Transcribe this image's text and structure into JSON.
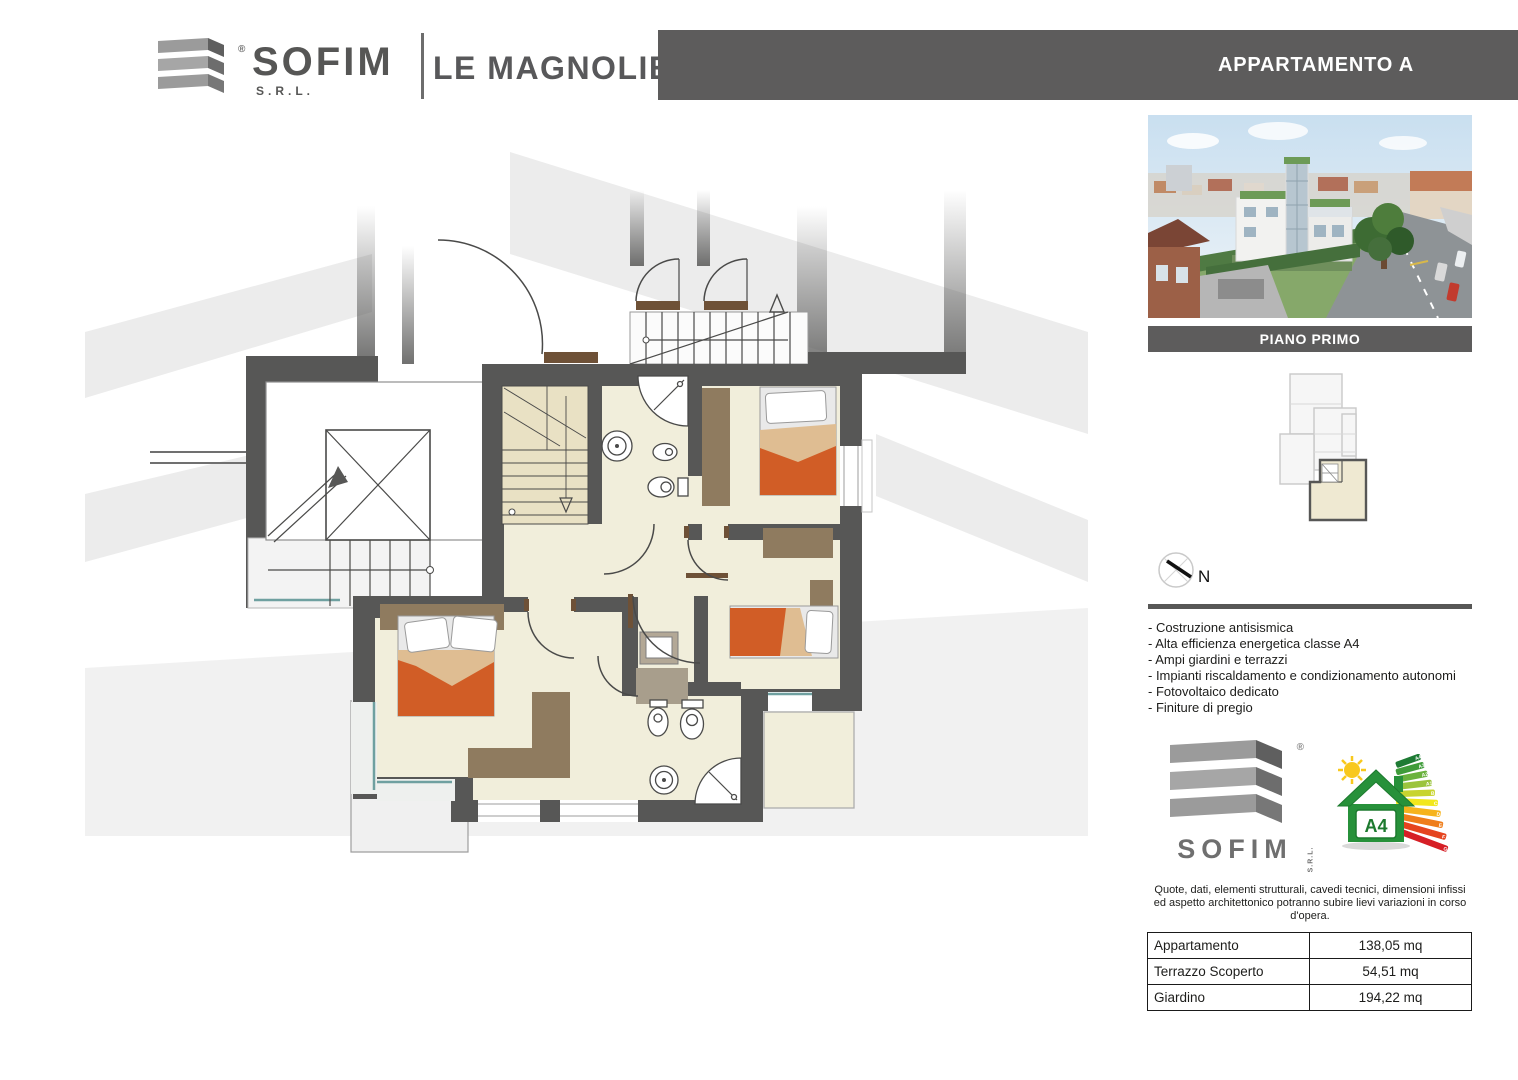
{
  "header": {
    "brand": {
      "name": "SOFIM",
      "suffix": "S.R.L.",
      "registered": "®"
    },
    "project": "LE MAGNOLIE",
    "apartment_label": "APPARTAMENTO A"
  },
  "panel": {
    "floor_label": "PIANO PRIMO",
    "compass_label": "N",
    "features": [
      "- Costruzione antisismica",
      "- Alta efficienza energetica classe A4",
      "- Ampi giardini e terrazzi",
      "- Impianti riscaldamento e condizionamento autonomi",
      "- Fotovoltaico dedicato",
      "- Finiture di pregio"
    ],
    "footer_logo": {
      "name": "SOFIM",
      "suffix": "S.R.L.",
      "registered": "®"
    },
    "energy": {
      "class_label": "A4",
      "scale": [
        "A4",
        "A3",
        "A2",
        "A1",
        "B",
        "C",
        "D",
        "E",
        "F",
        "G"
      ]
    },
    "disclaimer": {
      "line1": "Quote, dati, elementi strutturali, cavedi tecnici, dimensioni infissi",
      "line2": "ed aspetto architettonico potranno subire lievi variazioni in corso d'opera."
    },
    "table": {
      "rows": [
        {
          "label": "Appartamento",
          "value": "138,05 mq"
        },
        {
          "label": "Terrazzo Scoperto",
          "value": "54,51 mq"
        },
        {
          "label": "Giardino",
          "value": "194,22 mq"
        }
      ]
    }
  },
  "colors": {
    "header_bar": "#5d5c5c",
    "wall": "#575756",
    "floor": "#f1eedb",
    "stair": "#e9e1c4",
    "bed_orange": "#d15d26",
    "blanket_tan": "#dfbd92",
    "furniture_brown": "#8f7b5f",
    "threshold_brown": "#6e5137",
    "accent_teal": "#6fa0a0",
    "energy_green": "#27913a"
  }
}
